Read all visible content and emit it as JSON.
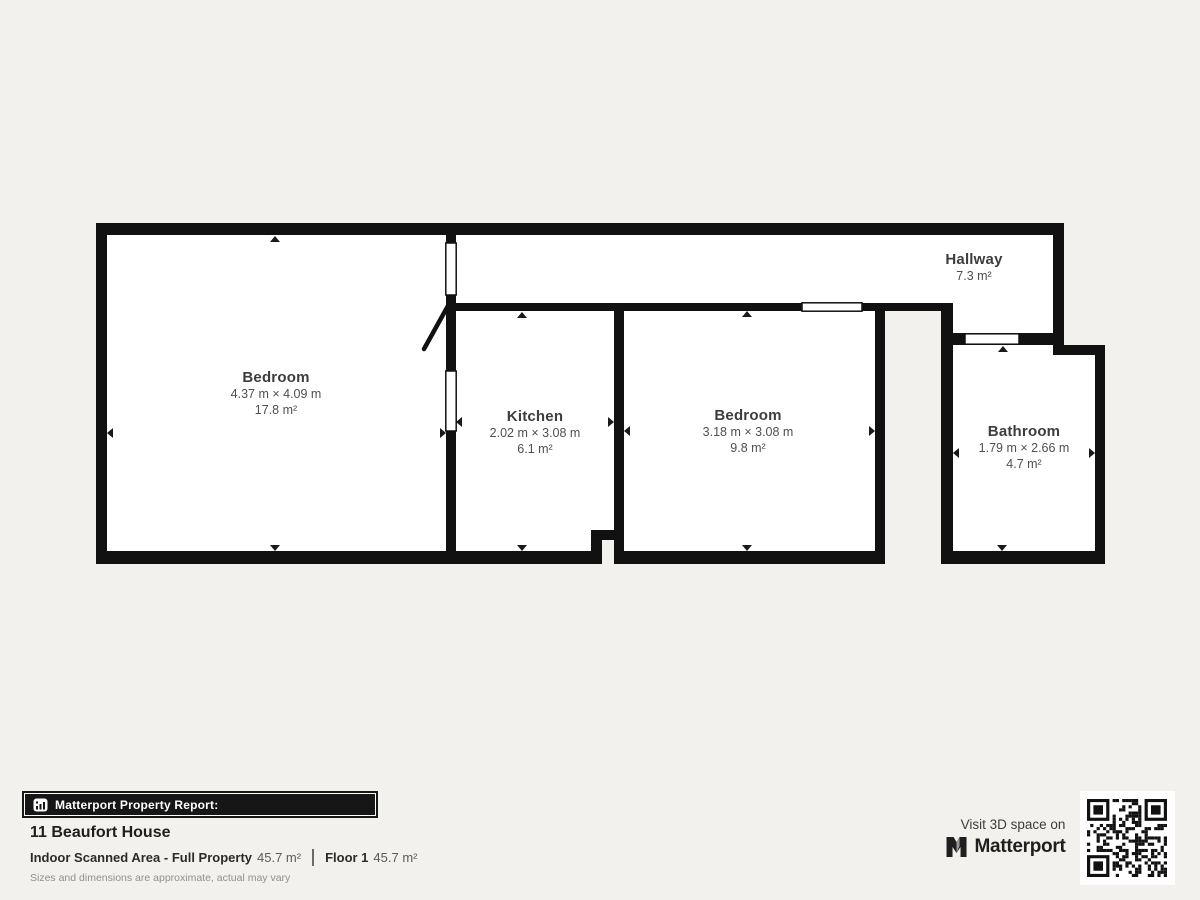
{
  "page": {
    "background": "#f2f1ee"
  },
  "floorplan": {
    "wall_color": "#111111",
    "room_fill": "#ffffff",
    "rooms": [
      {
        "name": "Bedroom",
        "dimensions": "4.37 m × 4.09 m",
        "area": "17.8 m²"
      },
      {
        "name": "Kitchen",
        "dimensions": "2.02 m × 3.08 m",
        "area": "6.1 m²"
      },
      {
        "name": "Bedroom",
        "dimensions": "3.18 m × 3.08 m",
        "area": "9.8 m²"
      },
      {
        "name": "Hallway",
        "area": "7.3 m²"
      },
      {
        "name": "Bathroom",
        "dimensions": "1.79 m × 2.66 m",
        "area": "4.7 m²"
      }
    ]
  },
  "report": {
    "bar_label": "Matterport Property Report:",
    "property_name": "11 Beaufort House",
    "scanned_area_label": "Indoor Scanned Area - Full Property",
    "scanned_area_value": "45.7 m²",
    "floor_label": "Floor 1",
    "floor_value": "45.7 m²",
    "disclaimer": "Sizes and dimensions are approximate, actual may vary"
  },
  "cta": {
    "visit_text": "Visit 3D space on",
    "brand": "Matterport"
  }
}
